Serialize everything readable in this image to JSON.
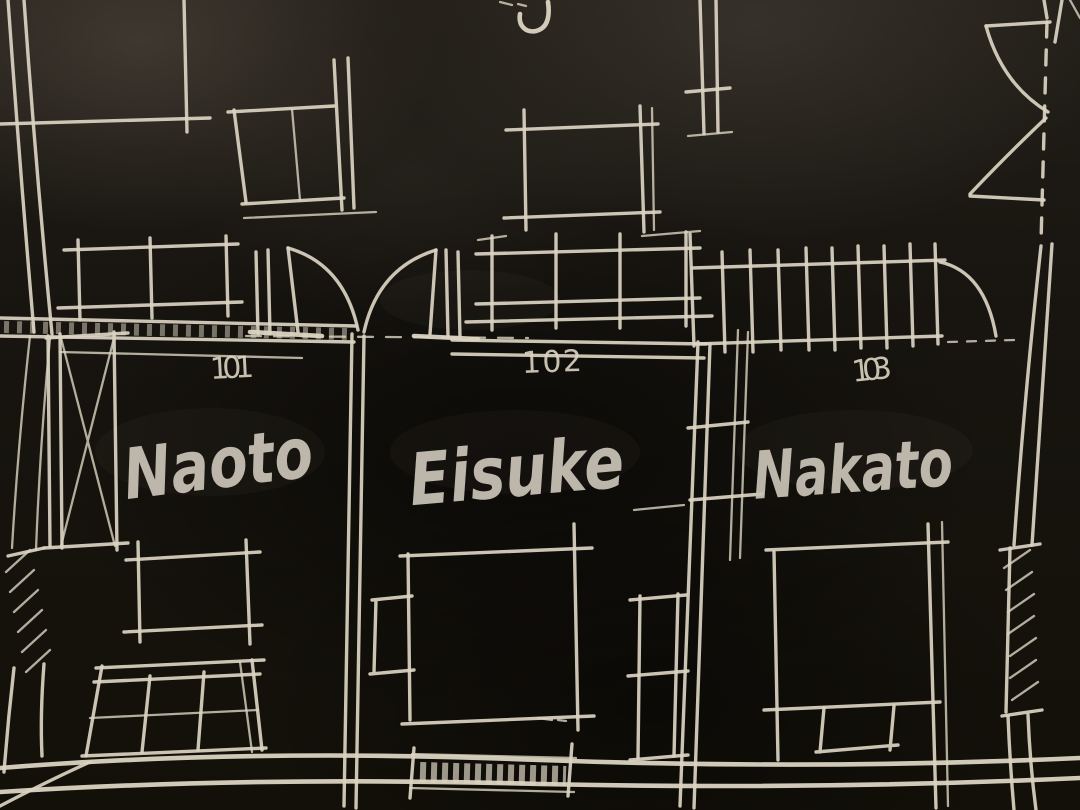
{
  "colors": {
    "background": "#16130e",
    "chalk": "#dbd4c2",
    "marker": "#c9c3b7"
  },
  "rooms": [
    {
      "number": "101",
      "name": "Naoto"
    },
    {
      "number": "102",
      "name": "Eisuke"
    },
    {
      "number": "103",
      "name": "Nakato"
    }
  ],
  "partial_top_text": "j"
}
